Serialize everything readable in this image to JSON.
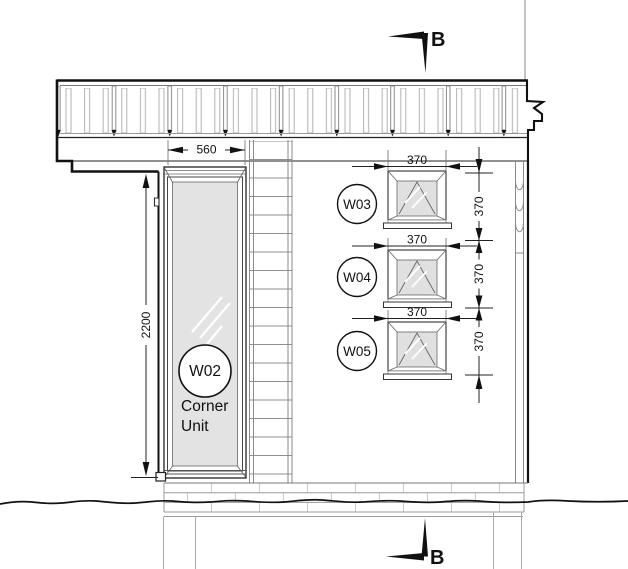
{
  "drawing_type": "elevation",
  "section_markers": {
    "top": {
      "label": "B"
    },
    "bottom": {
      "label": "B"
    }
  },
  "windows": {
    "w02": {
      "tag": "W02",
      "note_line1": "Corner",
      "note_line2": "Unit",
      "width_mm": "560",
      "height_mm": "2200"
    },
    "w03": {
      "tag": "W03",
      "width_mm": "370",
      "height_mm": "370"
    },
    "w04": {
      "tag": "W04",
      "width_mm": "370",
      "height_mm": "370"
    },
    "w05": {
      "tag": "W05",
      "width_mm": "370",
      "height_mm": "370"
    }
  },
  "colors": {
    "line_dark": "#111111",
    "line_medium": "#555555",
    "line_light": "#999999",
    "glazing_fill": "#e3e3e3",
    "background": "#ffffff"
  }
}
